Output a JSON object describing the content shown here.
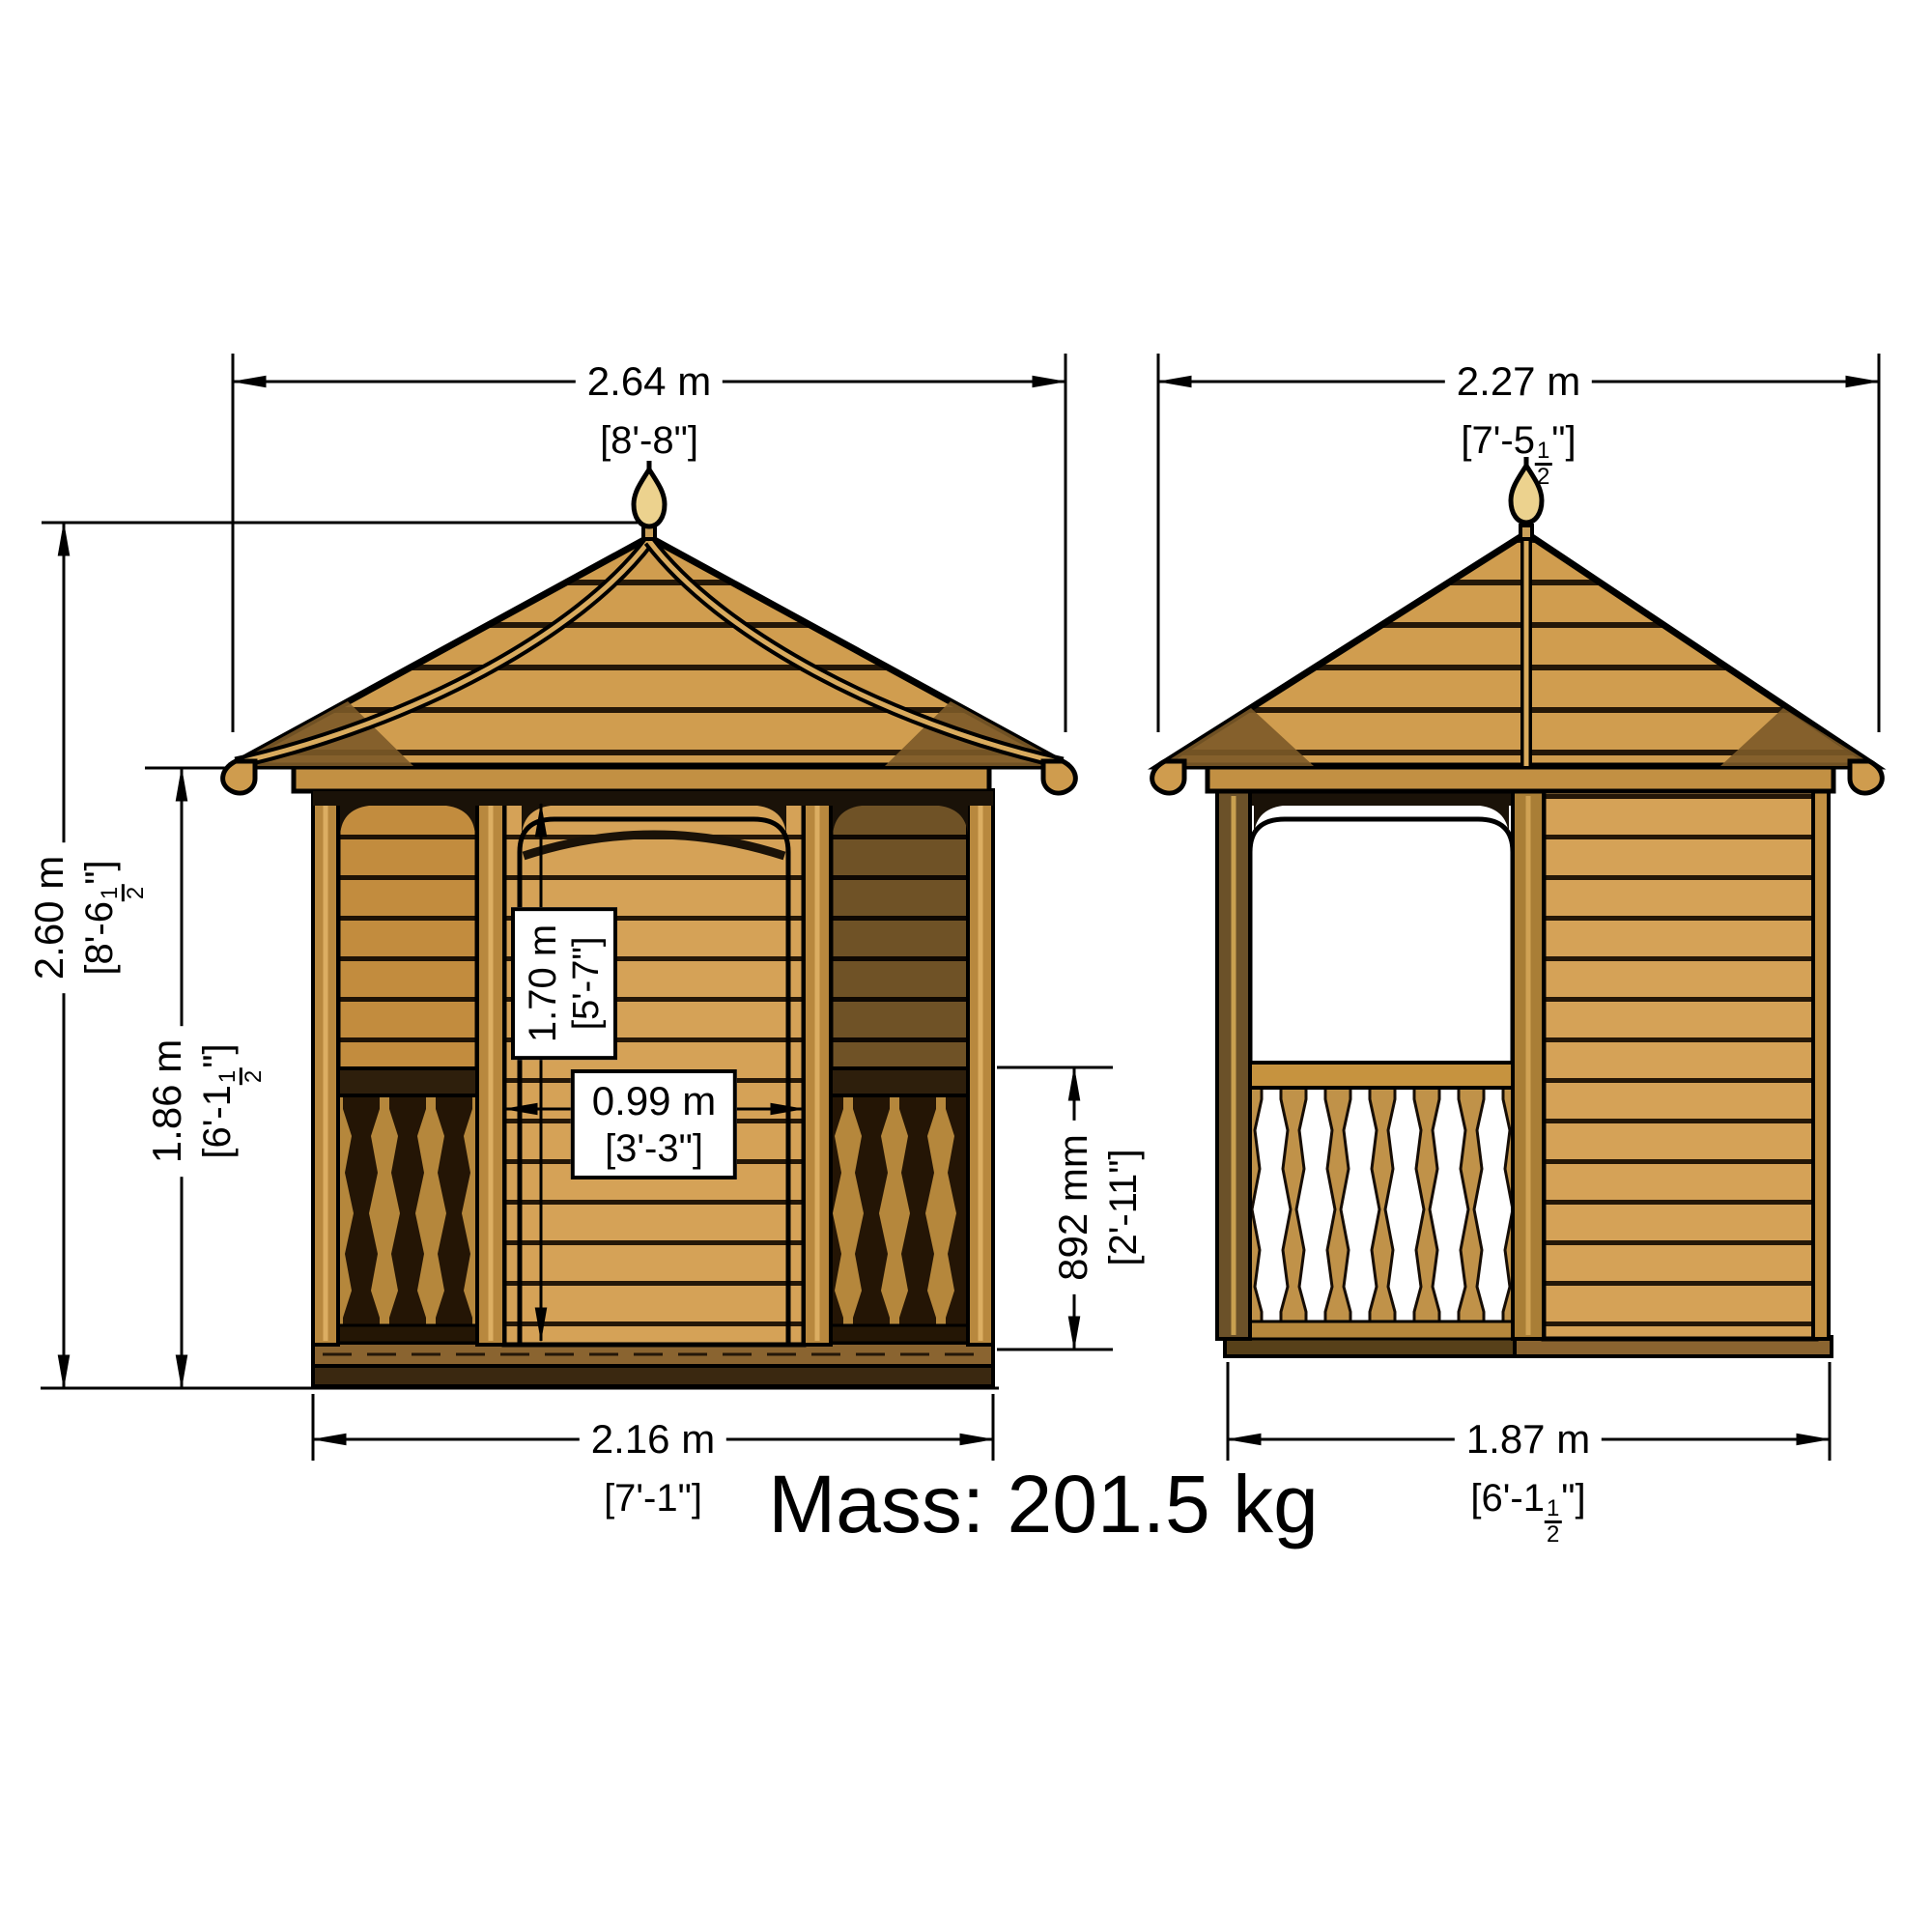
{
  "mass_label": "Mass: 201.5 kg",
  "dimensions": {
    "front_roof_width": {
      "metric": "2.64 m",
      "imperial": "[8'-8\"]"
    },
    "side_roof_width": {
      "metric": "2.27 m",
      "imp_pre": "[7'-5",
      "imp_num": "1",
      "imp_den": "2",
      "imp_post": "\"]"
    },
    "overall_height": {
      "metric": "2.60 m",
      "imp_pre": "[8'-6",
      "imp_num": "1",
      "imp_den": "2",
      "imp_post": "\"]"
    },
    "eaves_height": {
      "metric": "1.86 m",
      "imp_pre": "[6'-1",
      "imp_num": "1",
      "imp_den": "2",
      "imp_post": "\"]"
    },
    "door_height": {
      "metric": "1.70 m",
      "imperial": "[5'-7\"]"
    },
    "door_width": {
      "metric": "0.99 m",
      "imperial": "[3'-3\"]"
    },
    "railing_height": {
      "metric": "892 mm",
      "imperial": "[2'-11\"]"
    },
    "front_base_width": {
      "metric": "2.16 m",
      "imperial": "[7'-1\"]"
    },
    "side_base_width": {
      "metric": "1.87 m",
      "imp_pre": "[6'-1",
      "imp_num": "1",
      "imp_den": "2",
      "imp_post": "\"]"
    }
  },
  "colors": {
    "background": "#ffffff",
    "outline": "#000000",
    "wood_light": "#d5a257",
    "wood_mid": "#c28c3e",
    "wood_shadow": "#6f5226",
    "roof_wood": "#d09d4f",
    "finial": "#ecd28e",
    "dark_trim": "#241708"
  }
}
